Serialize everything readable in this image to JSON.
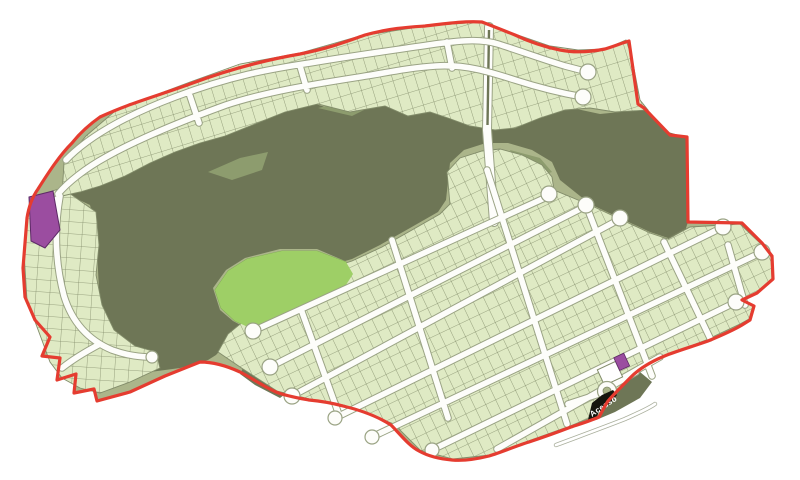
{
  "map": {
    "access_label": "Acesso",
    "colors": {
      "background": "#ffffff",
      "boundary_red": "#e53c30",
      "open_space_olive": "#6e7656",
      "open_space_light": "#8d9c6e",
      "buffer_sage": "#abb58a",
      "lot_fill": "#dfeac4",
      "lot_line": "#828c6a",
      "park_green": "#9ecf66",
      "road_white": "#fdfdfa",
      "road_casing": "#9aa384",
      "parcel_purple": "#9b4da0",
      "parcel_white": "#ffffff",
      "access_banner_black": "#15150e",
      "access_text": "#ffffff"
    }
  }
}
